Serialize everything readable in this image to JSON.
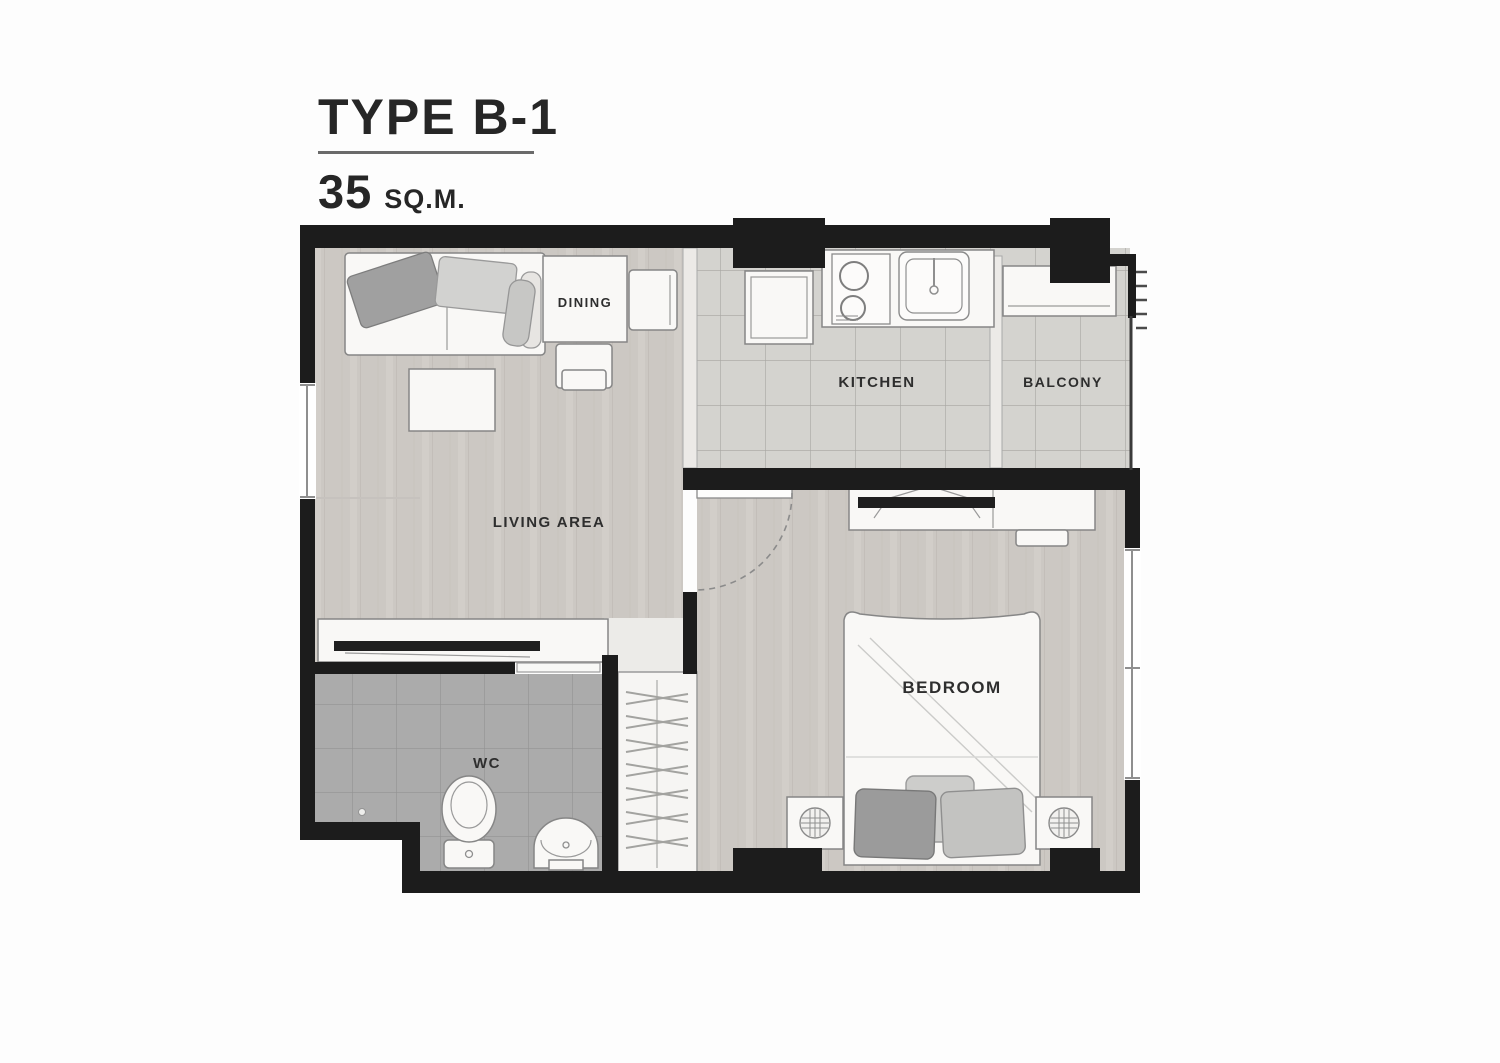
{
  "title": {
    "type_label": "TYPE B-1",
    "area_value": "35",
    "area_unit": "SQ.M."
  },
  "rooms": {
    "living": "LIVING AREA",
    "dining": "DINING",
    "kitchen": "KITCHEN",
    "balcony": "BALCONY",
    "bedroom": "BEDROOM",
    "wc": "WC"
  },
  "colors": {
    "wall": "#1c1c1c",
    "floor_wood": "#ccc8c3",
    "floor_wood_streak": "#bfbab5",
    "floor_tile": "#d4d3cf",
    "floor_tile_line": "#a7a6a2",
    "floor_wc": "#ababab",
    "floor_wc_line": "#939393",
    "furniture_fill": "#f9f8f6",
    "furniture_stroke": "#868686",
    "tv_black": "#1f1f1f",
    "label_text": "#2e2e2e",
    "title_text": "#262626",
    "underline": "#6a6a6a"
  }
}
